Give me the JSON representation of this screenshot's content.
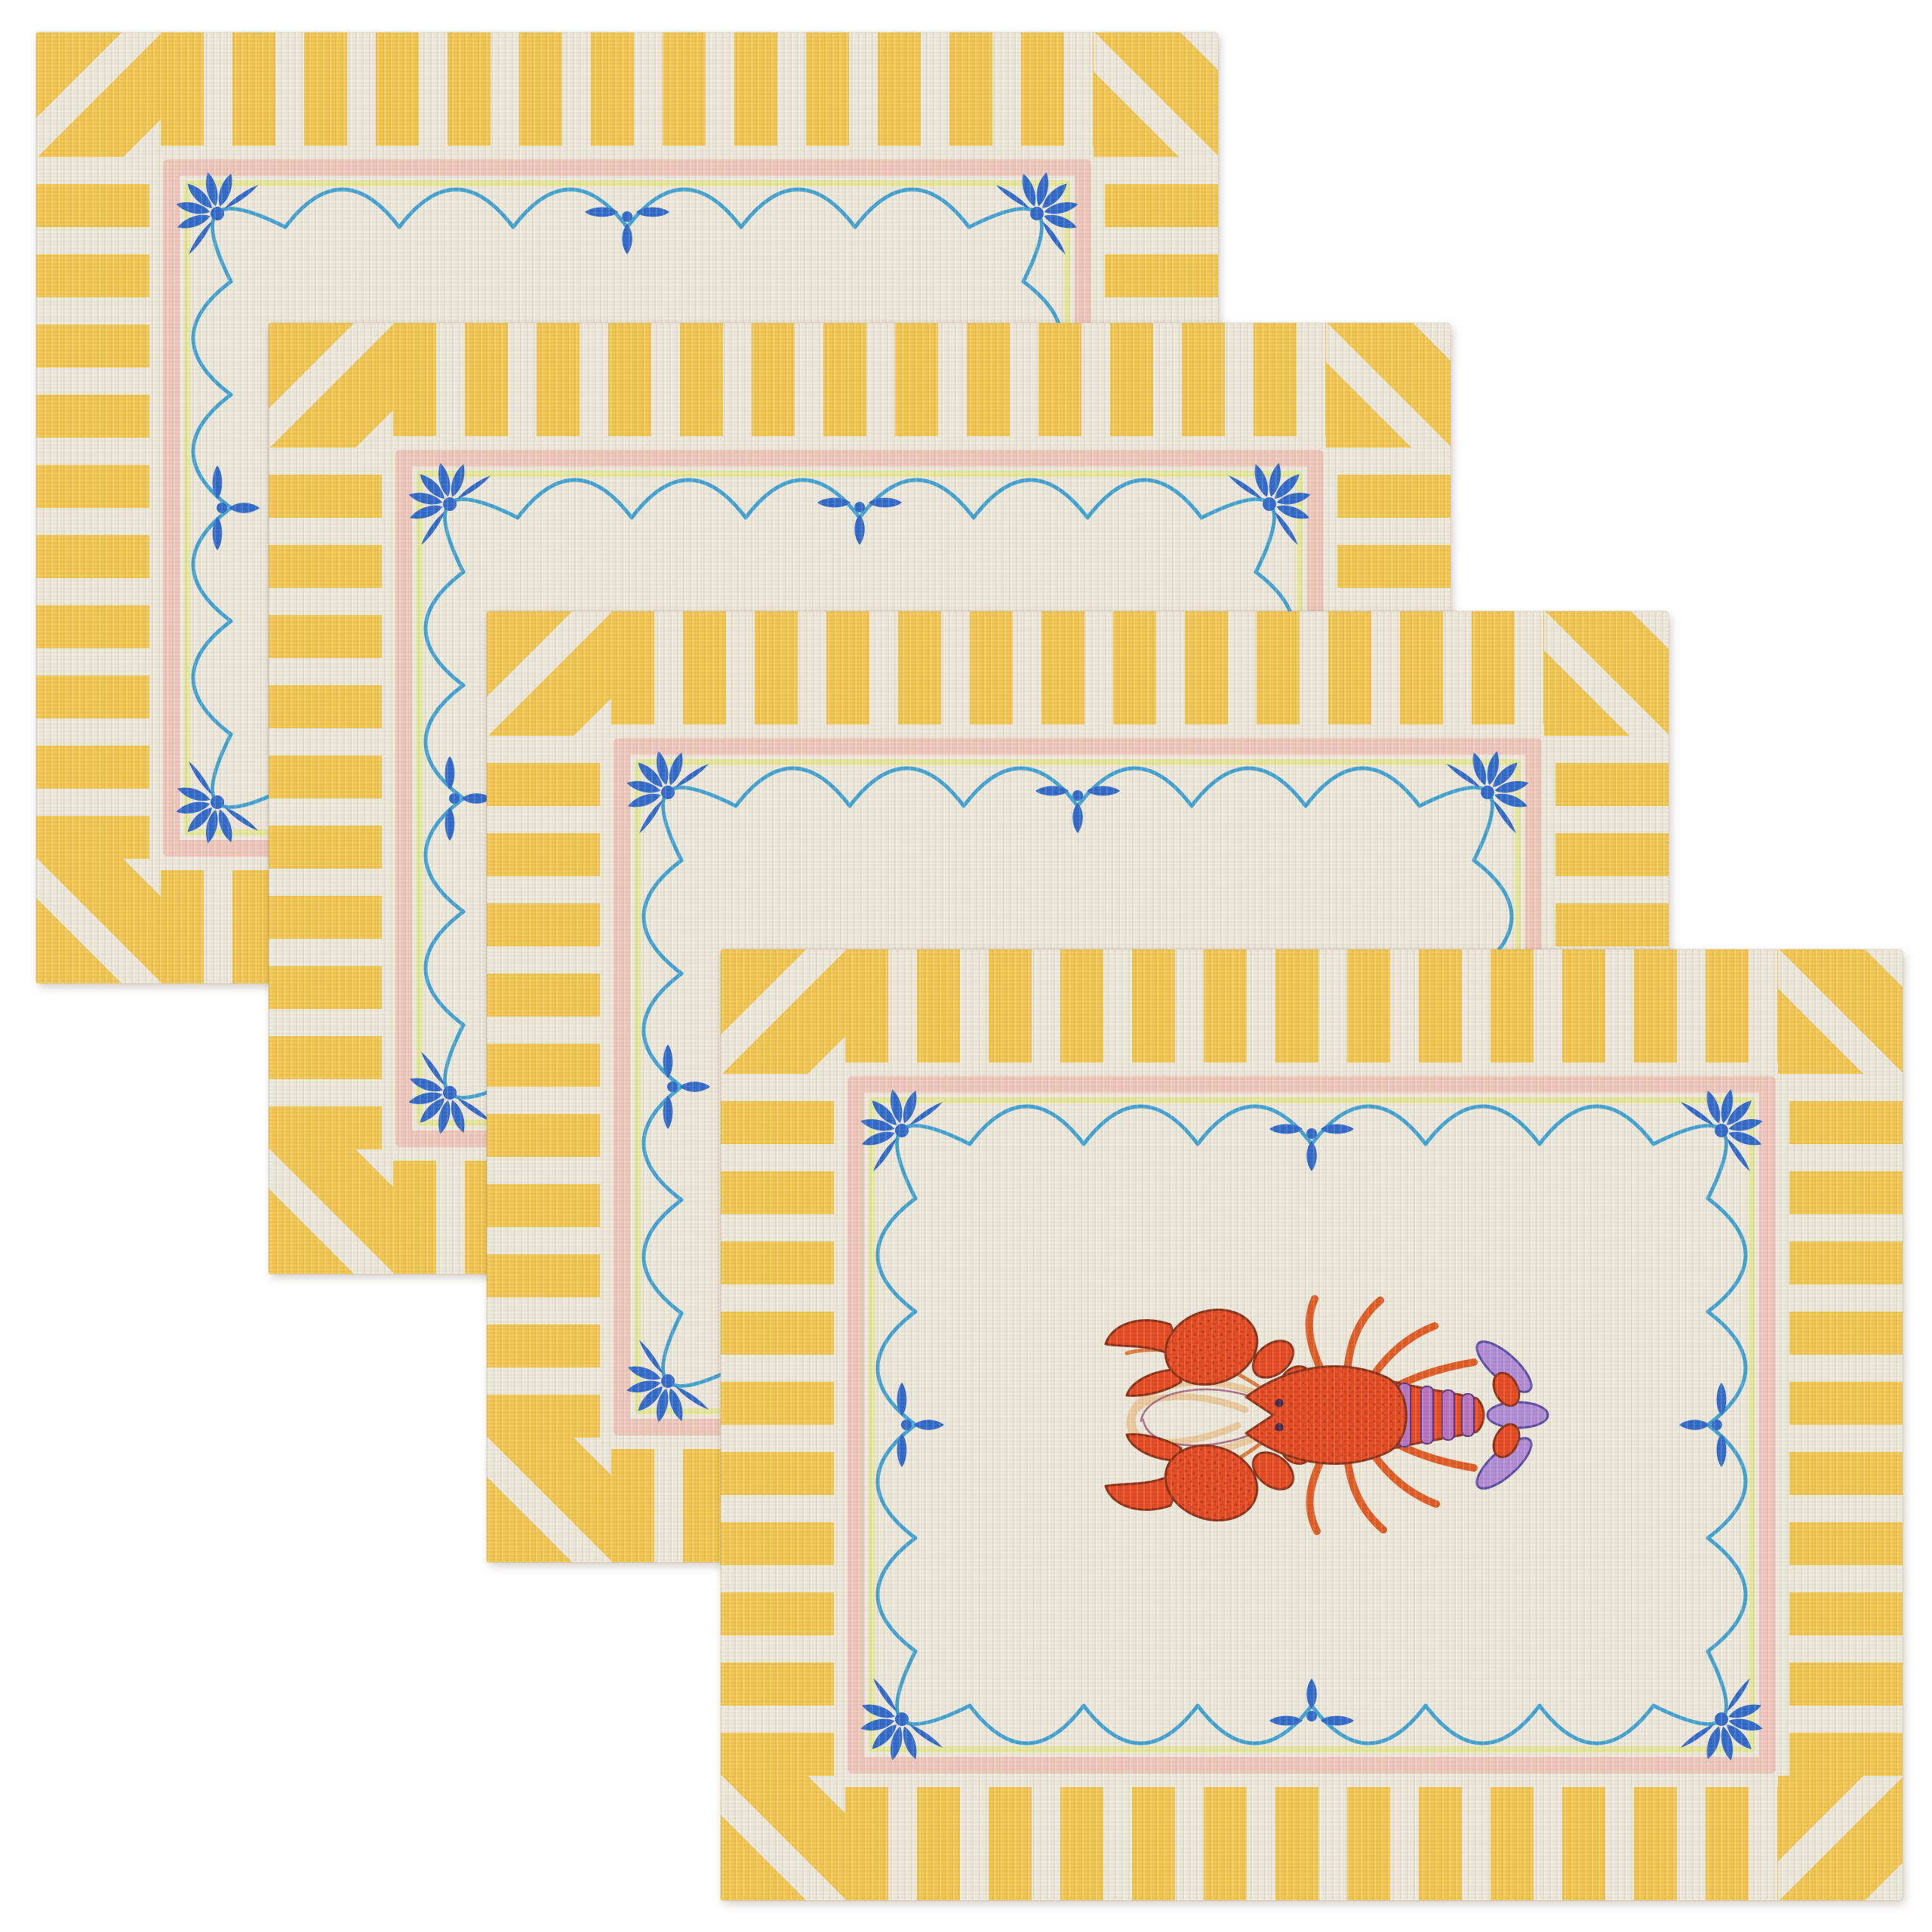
{
  "scene": {
    "description": "Set of four fanned ribbed-cotton placemats: yellow and white striped border with mitered diagonal corners, pink inner frame with pale green pinstripe, hand-drawn blue scalloped border with cobalt corner flowers and edge drop motifs, and a red-orange lobster with purple tail illustrated in the centre of the front placemat",
    "item_count": 4
  },
  "colors": {
    "stripe_yellow": "#F5C84E",
    "fabric_cream": "#F0EBDF",
    "frame_pink": "#F2C9BE",
    "line_green": "#E8EC9E",
    "scallop_blue": "#3BA2D6",
    "motif_cobalt": "#2B67CD",
    "lobster_red": "#E8451C",
    "lobster_outline": "#8A2A10",
    "lobster_leg": "#E2571F",
    "lobster_purple": "#B28BD9",
    "lobster_purple_dark": "#5548A6",
    "lobster_band_purple": "#B672C2",
    "antenna_cream": "#ECCB9F"
  },
  "placemats": [
    {
      "id": "placemat-1-back",
      "position": "back",
      "motif": "lobster"
    },
    {
      "id": "placemat-2-upper-middle",
      "position": "upper-middle",
      "motif": "lobster"
    },
    {
      "id": "placemat-3-lower-middle",
      "position": "lower-middle",
      "motif": "lobster"
    },
    {
      "id": "placemat-4-front",
      "position": "front",
      "motif": "lobster"
    }
  ]
}
